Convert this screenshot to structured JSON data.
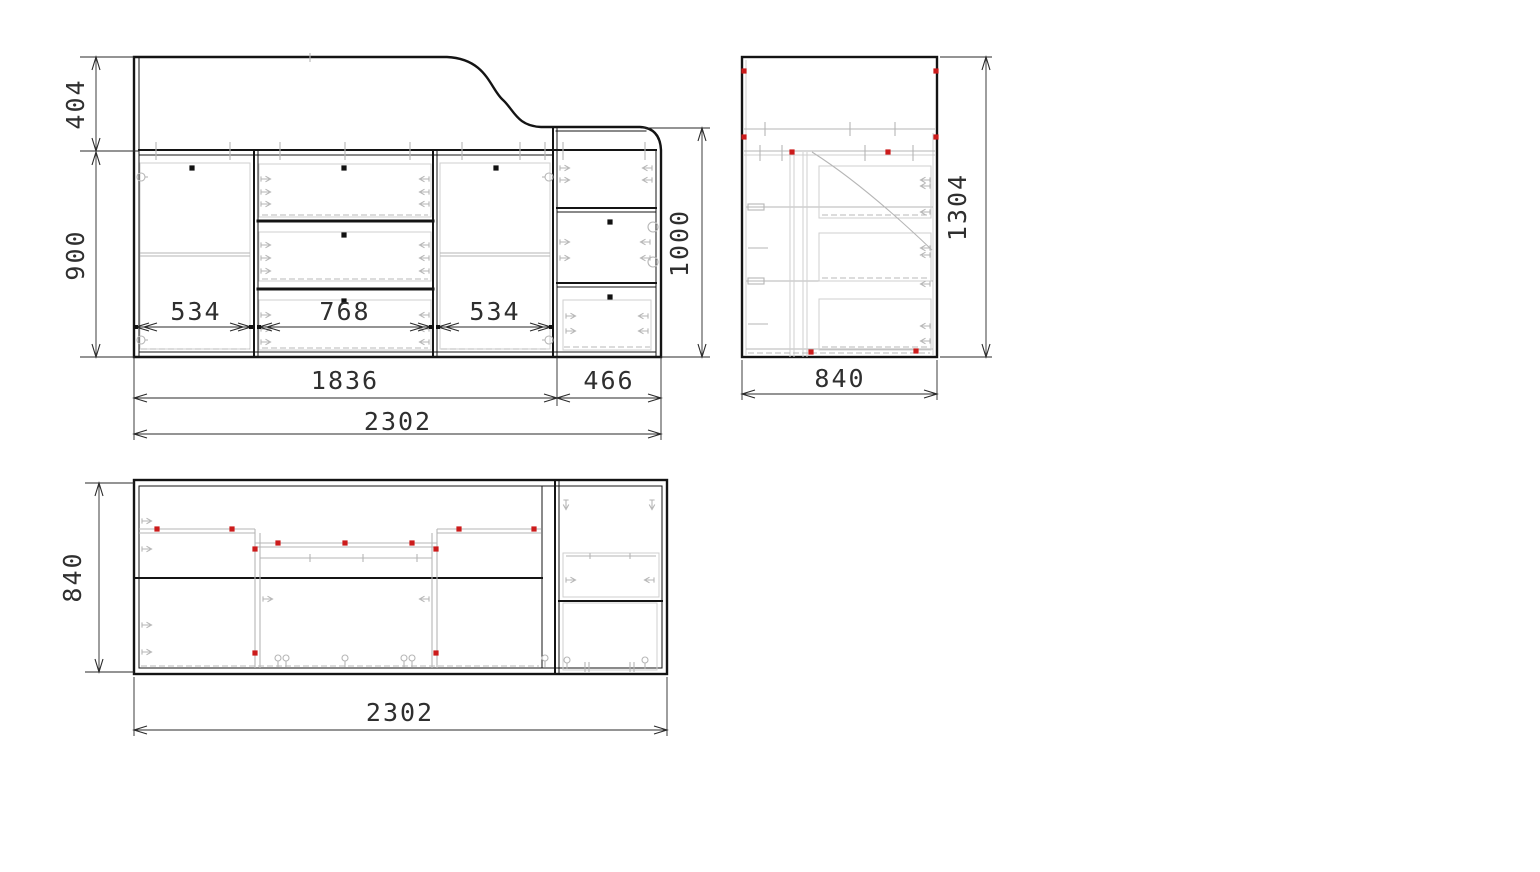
{
  "drawing": {
    "description": "three-view CAD drawing of a loft-bed cabinet unit",
    "colors": {
      "outline": "#141414",
      "hardware_gray": "#b6b6b6",
      "fastener_marker": "#cc1b1b",
      "dimension_text": "#2f2f2f",
      "background": "#ffffff"
    },
    "views": {
      "front": {
        "label": "front view",
        "dims": {
          "upper_height": "404",
          "lower_height": "900",
          "left_door_width": "534",
          "drawer_bank_width": "768",
          "right_door_width": "534",
          "main_width": "1836",
          "tower_width": "466",
          "total_width": "2302",
          "tower_height": "1000"
        }
      },
      "side": {
        "label": "side view",
        "dims": {
          "depth": "840",
          "total_height": "1304"
        }
      },
      "plan": {
        "label": "plan view",
        "dims": {
          "depth": "840",
          "total_width": "2302"
        }
      }
    }
  }
}
